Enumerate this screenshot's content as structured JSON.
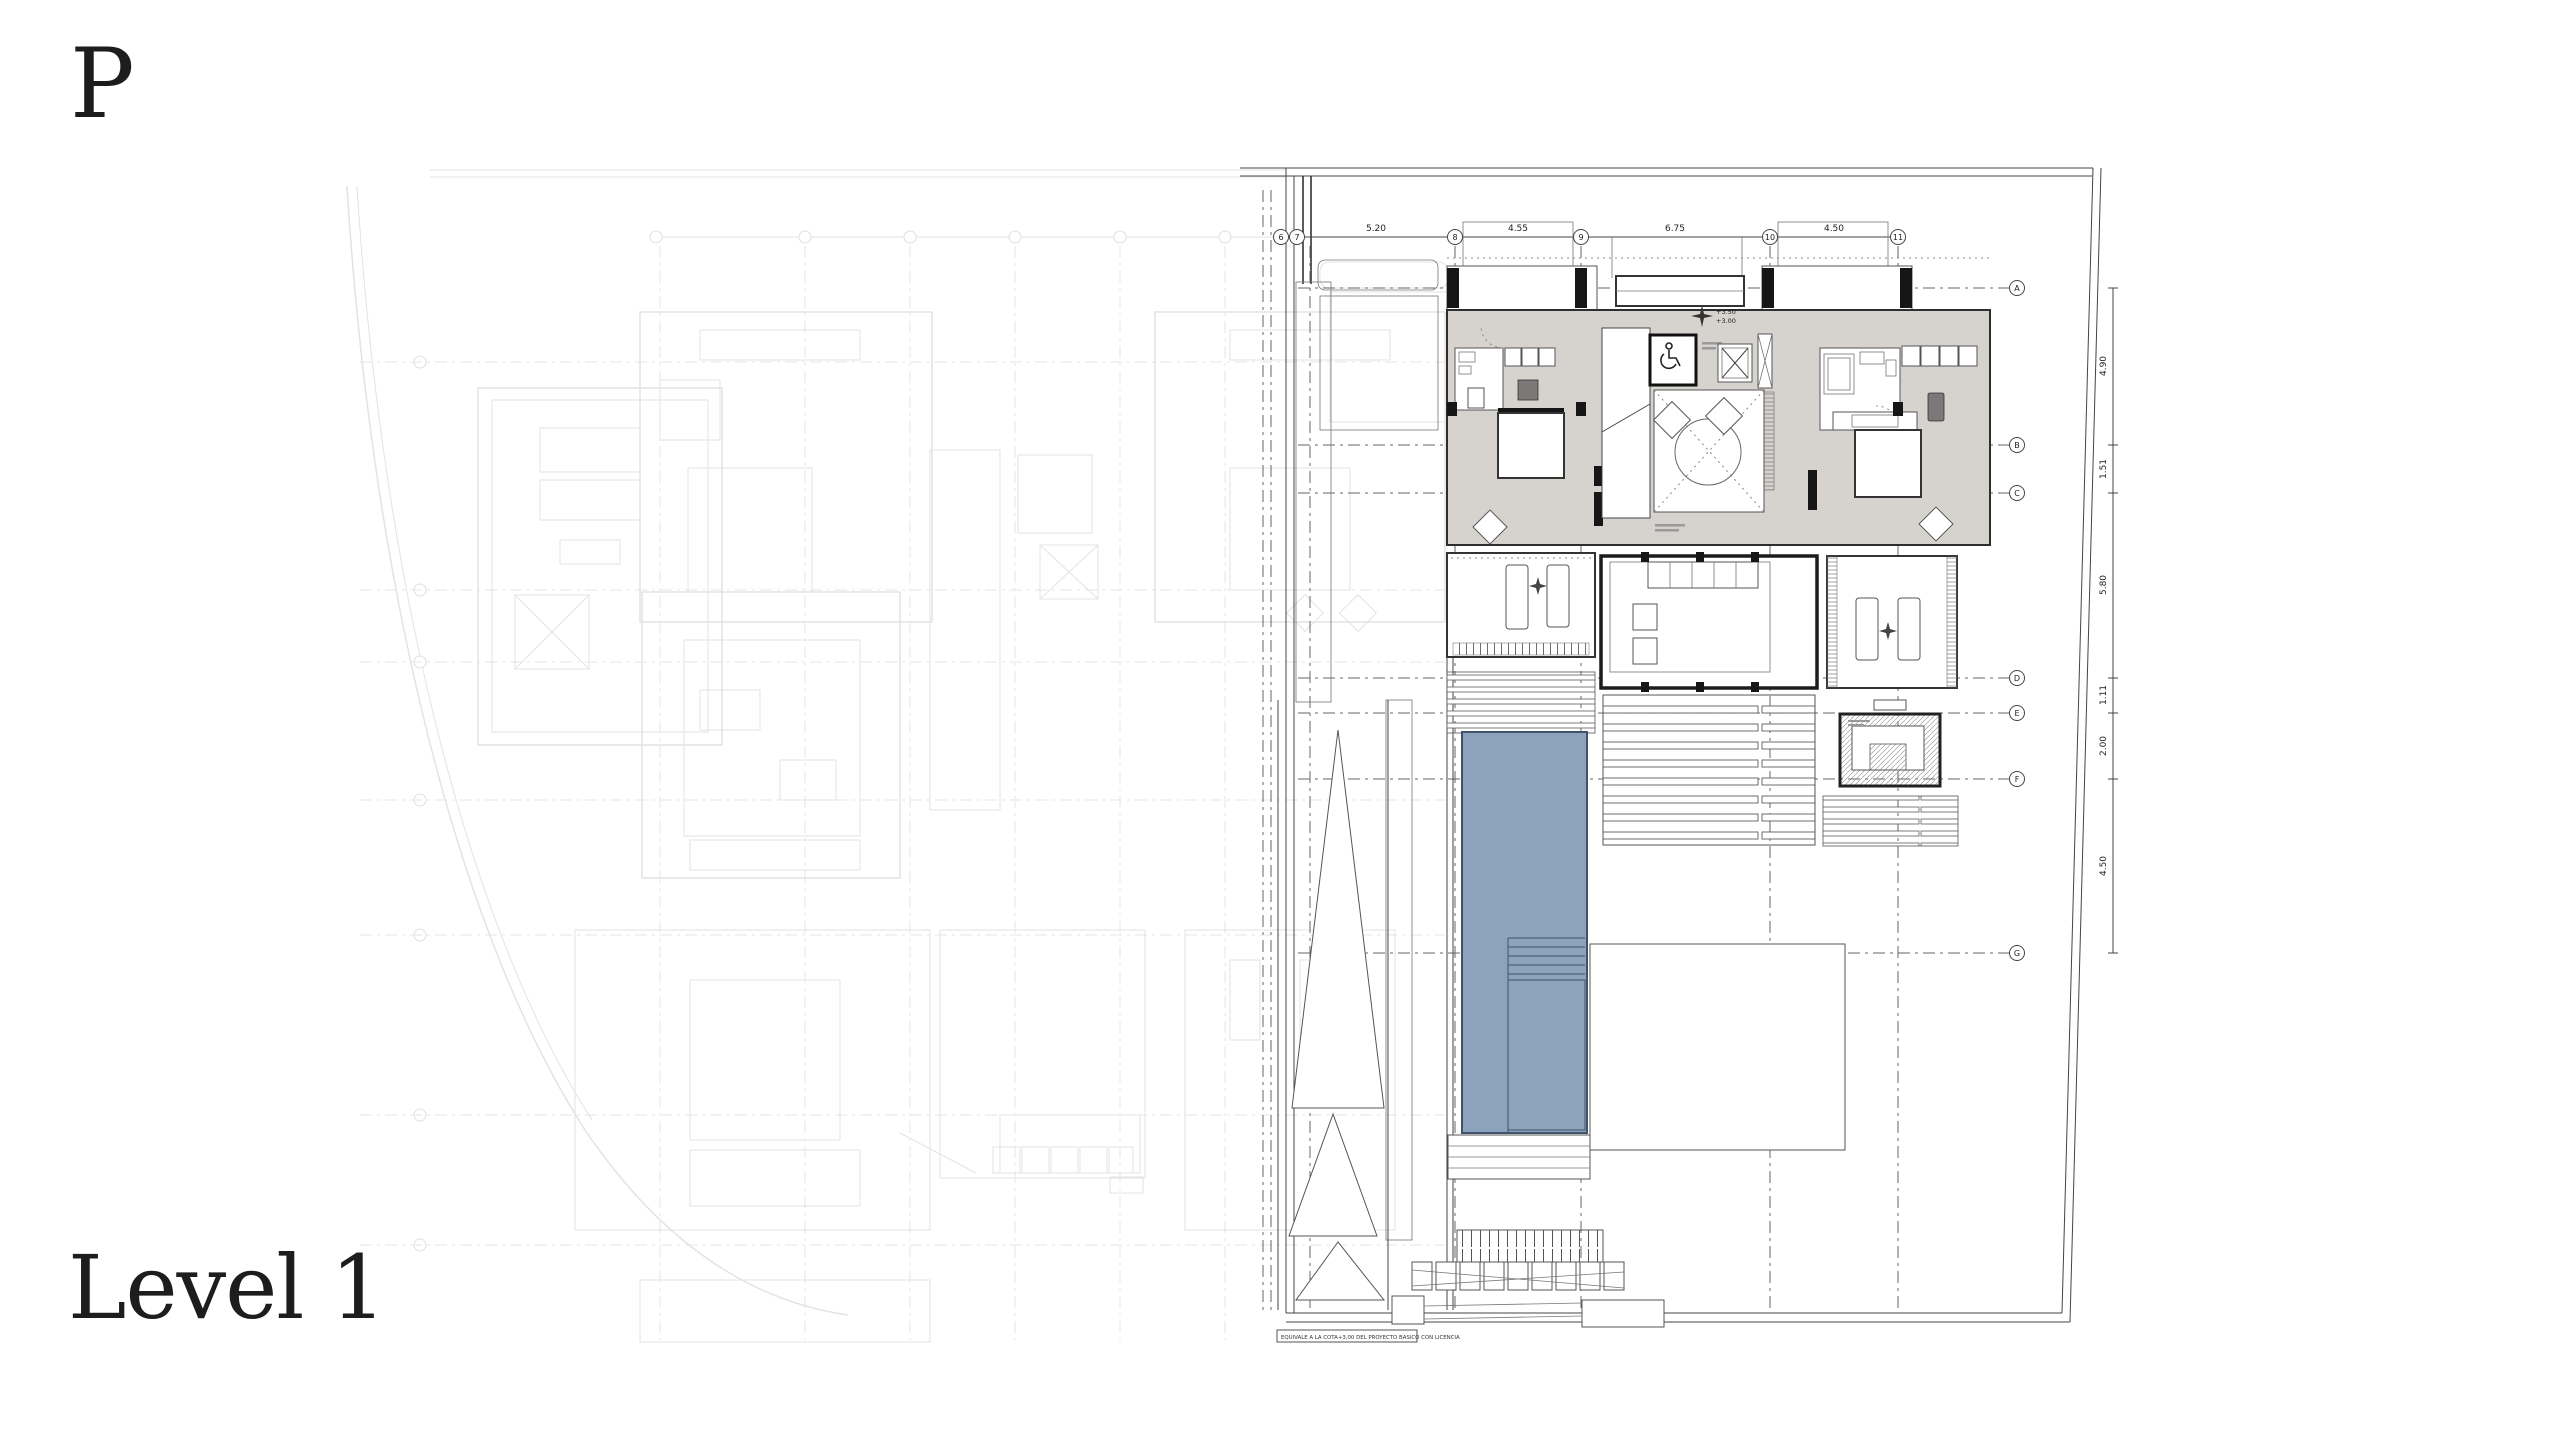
{
  "page": {
    "plan_letter": "P",
    "level_label": "Level 1"
  },
  "colors": {
    "pool_fill": "#8ca2bd",
    "pool_edge": "#41536a",
    "room_fill": "#d6d3cf",
    "wall": "#2e2e2e",
    "line_mid": "#666666",
    "ghost_gray": "#9a9a9a"
  },
  "dims": {
    "top": {
      "bubbles": [
        "6",
        "7",
        "8",
        "9",
        "10",
        "11"
      ],
      "values": [
        "5.20",
        "4.55",
        "6.75",
        "4.50"
      ]
    },
    "right": {
      "bubbles": [
        "A",
        "B",
        "C",
        "D",
        "E",
        "F",
        "G"
      ],
      "values": [
        "4.90",
        "1.51",
        "5.80",
        "1.11",
        "2.00",
        "4.50"
      ]
    }
  },
  "markers": {
    "level_upper": "+3.50",
    "level_lower": "+3.00"
  },
  "notes": {
    "license": "EQUIVALE A LA COTA+3,00 DEL PROYECTO BASICO CON LICENCIA"
  },
  "icons": {
    "wheelchair": "wheelchair-accessible-icon",
    "datum_star": "four-point-star-icon",
    "elevator": "elevator-x-shaft-icon",
    "stairs": "stair-treads-icon"
  }
}
